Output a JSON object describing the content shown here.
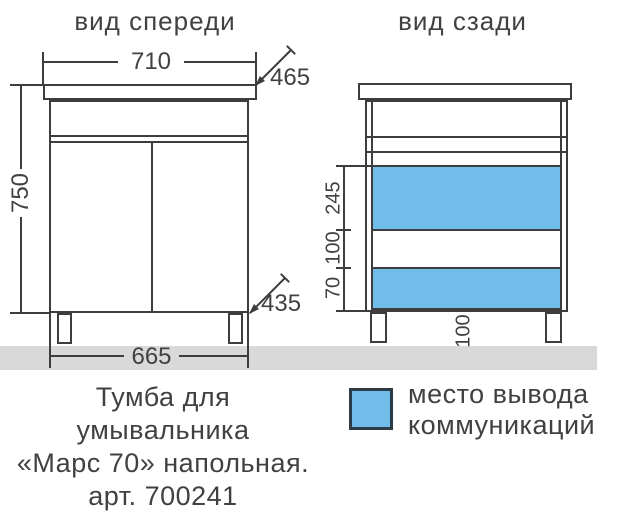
{
  "colors": {
    "line": "#3d3d3d",
    "text": "#414141",
    "communication_blue": "#6fbde8",
    "legend_border": "#2d3b47",
    "floor_gray": "#d9d9d9"
  },
  "front_view": {
    "title": "вид спереди",
    "dim_top_width": "710",
    "dim_top_depth": "465",
    "dim_height": "750",
    "dim_bottom_depth": "435",
    "dim_bottom_width": "665"
  },
  "back_view": {
    "title": "вид сзади",
    "dim_segment_upper": "245",
    "dim_segment_middle": "100",
    "dim_segment_lower": "70",
    "dim_leg_height": "100"
  },
  "legend": {
    "label_line1": "место вывода",
    "label_line2": "коммуникаций"
  },
  "caption": {
    "line1": "Тумба для",
    "line2": "умывальника",
    "line3": "«Марс 70» напольная.",
    "line4": "арт. 700241"
  }
}
